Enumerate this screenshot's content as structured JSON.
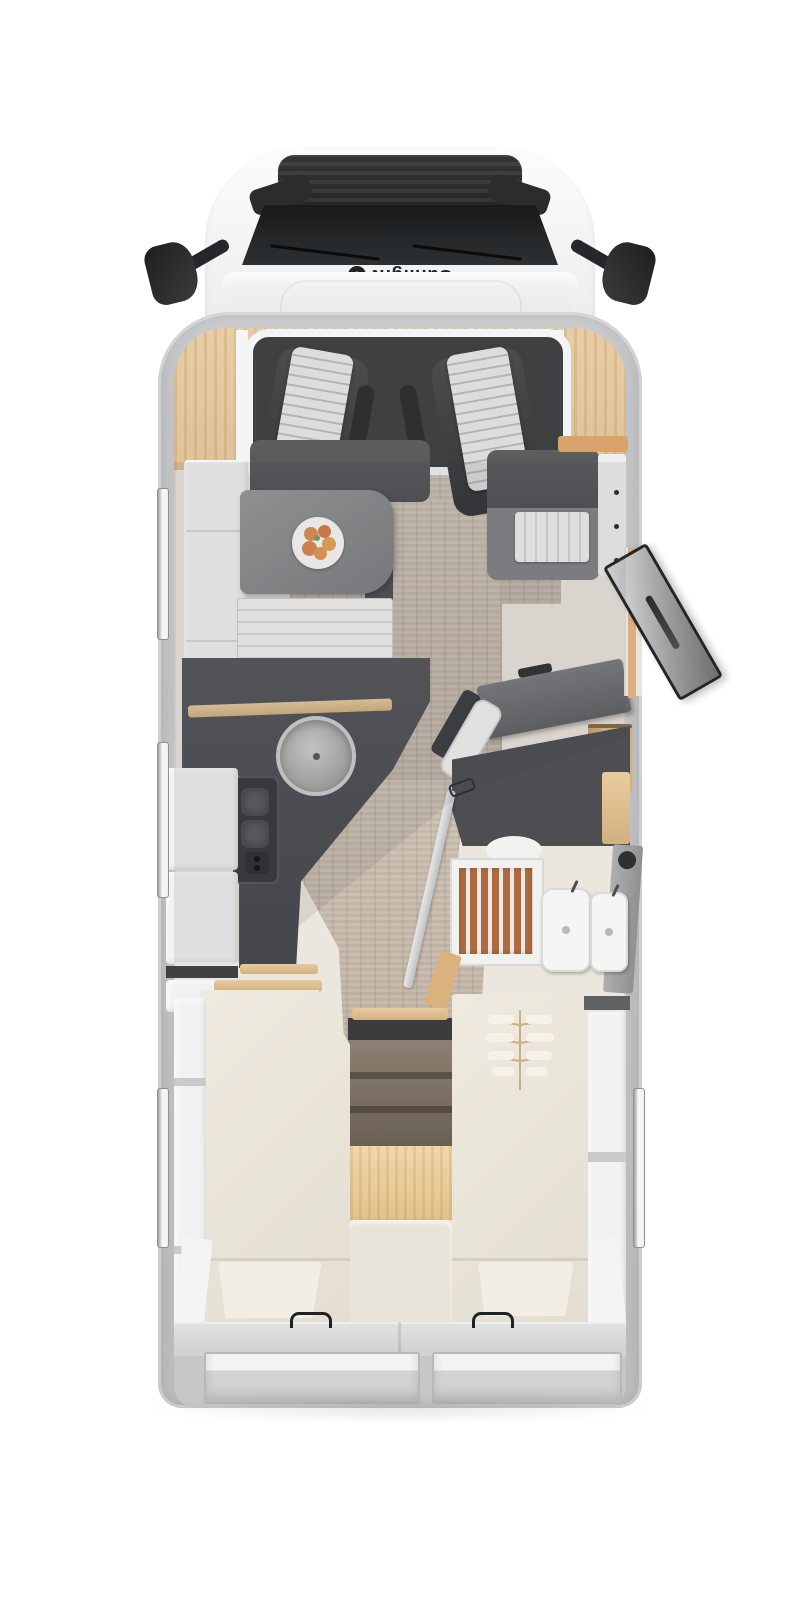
{
  "brand": {
    "label": "Sunlight",
    "icon": "sunlight-sun-icon"
  },
  "icons": {
    "sun_glyph": "✳"
  },
  "palette": {
    "bg": "#ffffff",
    "cab_white": "#f4f6f7",
    "windshield": "#1d1f21",
    "vent_dark": "#2b2d2f",
    "wall_gray": "#c2c3c5",
    "wood_panel": "#e5c9a0",
    "cab_floor": "#3e4042",
    "seat_dark": "#424446",
    "stripe_light": "#dcdddb",
    "stripe_dark": "#b4b5b3",
    "floor_cream": "#ebe7de",
    "floor_wood": "#c9bdaf",
    "table_gray": "#8b8d8f",
    "charcoal": "#515356",
    "counter_dark": "#4b4d50",
    "wood_trim": "#e0c497",
    "cabinet_white": "#f1f2f2",
    "stove_dark": "#37393b",
    "slat_brown": "#b06a3f",
    "porcelain": "#f5f5f3",
    "mattress": "#ece7db",
    "step_wood_dark": "#7e7366",
    "step_wood_light": "#ecd2a2",
    "platform_gray": "#d5d6d6",
    "window_white": "#f8f9f9",
    "door_dark": "#333537",
    "tan_accent": "#ddb37e",
    "logo_dark": "#1f2123",
    "plant_stem": "#c9a87c"
  }
}
